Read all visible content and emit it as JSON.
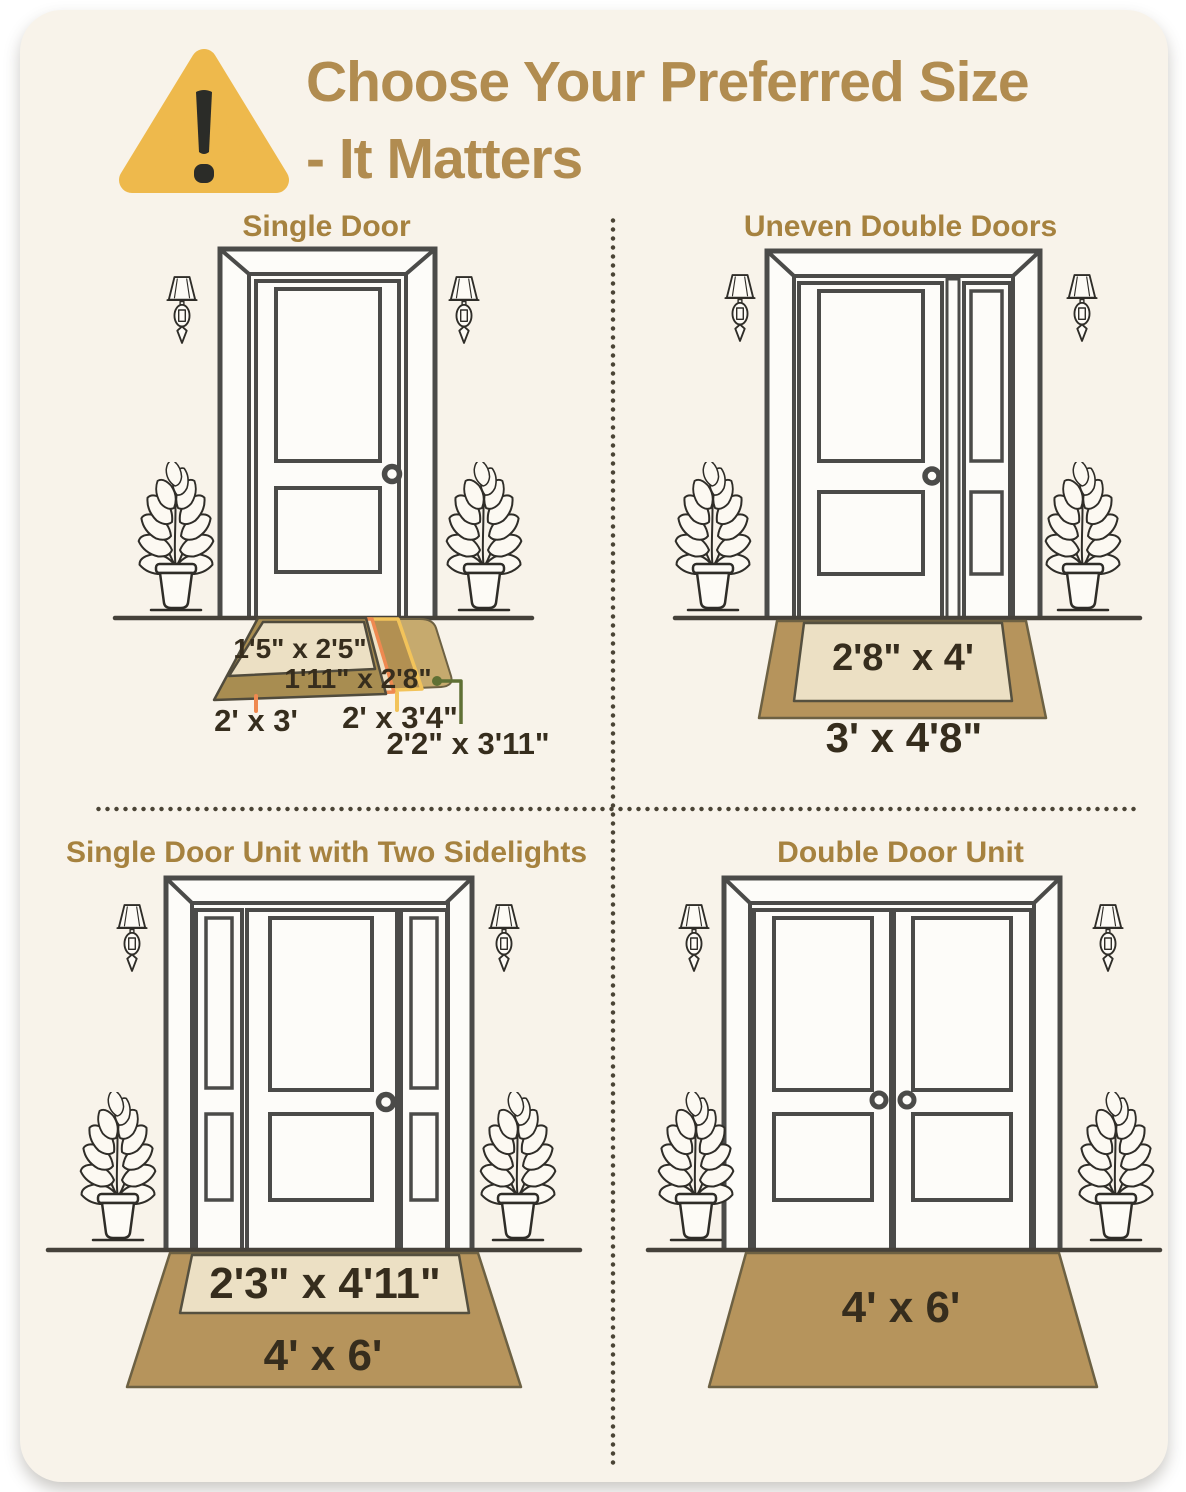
{
  "title": {
    "line1": "Choose Your Preferred Size",
    "line2": "- It Matters"
  },
  "quadrants": {
    "q1": {
      "heading": "Single Door",
      "sizes": {
        "s1": "1'5\" x 2'5\"",
        "s2": "1'11\" x 2'8\"",
        "s3": "2' x 3'",
        "s4": "2' x 3'4\"",
        "s5": "2'2\" x 3'11\""
      }
    },
    "q2": {
      "heading": "Uneven Double Doors",
      "sizes": {
        "inner": "2'8\" x 4'",
        "outer": "3' x 4'8\""
      }
    },
    "q3": {
      "heading": "Single Door Unit with Two Sidelights",
      "sizes": {
        "inner": "2'3\" x 4'11\"",
        "outer": "4' x 6'"
      }
    },
    "q4": {
      "heading": "Double Door Unit",
      "sizes": {
        "outer": "4' x 6'"
      }
    }
  },
  "colors": {
    "card_bg": "#f8f3ea",
    "accent_gold": "#b18c50",
    "heading_gold": "#a6823f",
    "warning_yellow": "#eeb94c",
    "mat_tan": "#b6945c",
    "mat_cream": "#ece0c4",
    "mat_khaki": "#a88d51",
    "mat_back_tan": "#c6aa6e",
    "leader_orange": "#ef8950",
    "leader_yellow": "#f2c35a",
    "leader_olive": "#5f7034",
    "label_dark": "#362d1d"
  }
}
